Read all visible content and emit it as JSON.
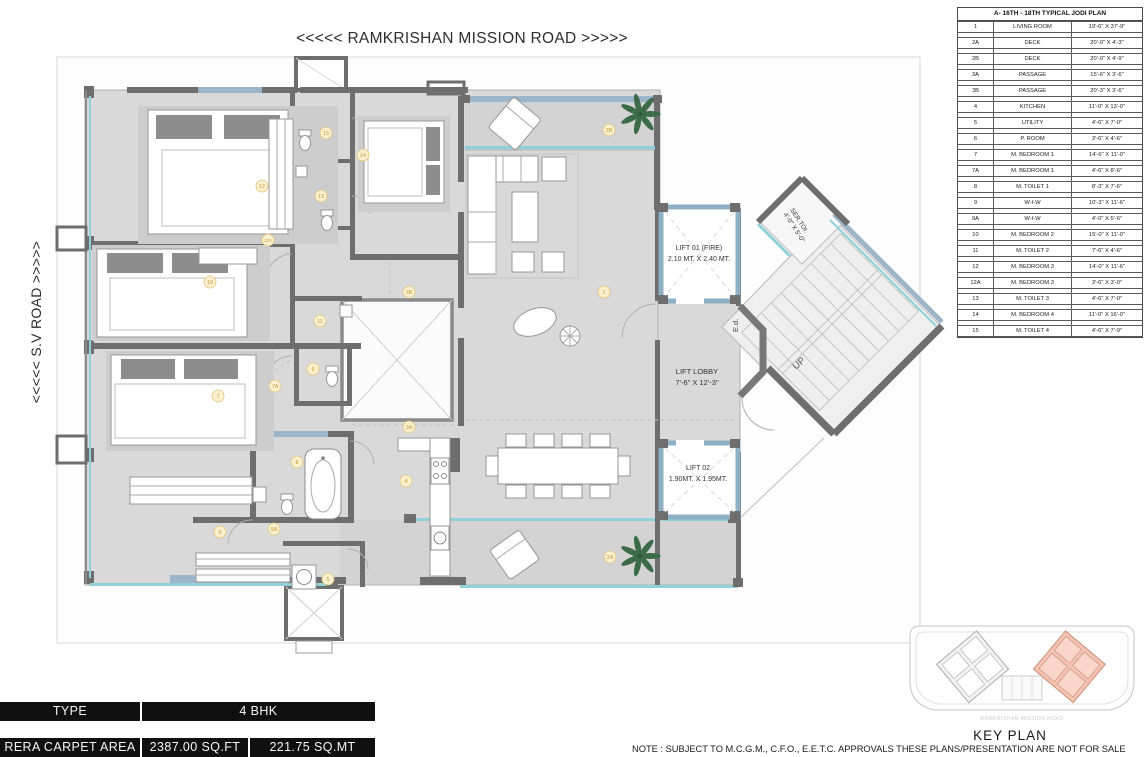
{
  "sheet": {
    "road_top": "<<<<< RAMKRISHAN MISSION ROAD >>>>>",
    "road_left": "<<<<< S.V ROAD >>>>>"
  },
  "plan": {
    "lift1_line1": "LIFT 01 (FIRE)",
    "lift1_line2": "2.10 MT.  X 2.40 MT.",
    "lobby_line1": "LIFT LOBBY",
    "lobby_line2": "7'-6\" X 12'-3\"",
    "lift2_line1": "LIFT 02",
    "lift2_line2": "1.90MT. X 1.95MT.",
    "sertoi_line1": "SER.TOI.",
    "sertoi_line2": "4'-0\" X 5'-0\"",
    "up": "UP",
    "ed": "E.d.",
    "markers": [
      "1",
      "2A",
      "2B",
      "3A",
      "3B",
      "4",
      "5",
      "6",
      "7",
      "7A",
      "8",
      "9",
      "9A",
      "10",
      "11",
      "12",
      "12A",
      "13",
      "14",
      "15"
    ]
  },
  "schedule": {
    "title": "A- 16TH - 18TH TYPICAL JODI PLAN",
    "rows": [
      [
        "1",
        "LIVING ROOM",
        "19'-6\" X 37'-9\""
      ],
      [
        "2A",
        "DECK",
        "20'-0\" X 4'-3\""
      ],
      [
        "2B",
        "DECK",
        "20'-0\" X 4'-9\""
      ],
      [
        "3A",
        "PASSAGE",
        "15'-6\" X 3'-6\""
      ],
      [
        "3B",
        "PASSAGE",
        "20'-3\" X 3'-6\""
      ],
      [
        "4",
        "KITCHEN",
        "11'-0\" X 13'-0\""
      ],
      [
        "5",
        "UTILITY",
        "4'-6\" X 7'-0\""
      ],
      [
        "6",
        "P. ROOM",
        "3'-6\" X 4'-6\""
      ],
      [
        "7",
        "M. BEDROOM 1",
        "14'-6\" X 11'-0\""
      ],
      [
        "7A",
        "M. BEDROOM 1",
        "4'-6\" X 8'-6\""
      ],
      [
        "8",
        "M. TOILET 1",
        "8'-3\" X 7'-6\""
      ],
      [
        "9",
        "W-I-W",
        "10'-3\" X 11'-6\""
      ],
      [
        "9A",
        "W-I-W",
        "4'-0\" X 5'-6\""
      ],
      [
        "10",
        "M. BEDROOM 2",
        "15'-0\" X 11'-0\""
      ],
      [
        "11",
        "M. TOILET 2",
        "7'-6\" X 4'-6\""
      ],
      [
        "12",
        "M. BEDROOM 3",
        "14'-0\" X 11'-6\""
      ],
      [
        "12A",
        "M. BEDROOM 3",
        "3'-6\" X 3'-0\""
      ],
      [
        "13",
        "M. TOILET 3",
        "4'-6\" X 7'-0\""
      ],
      [
        "14",
        "M. BEDROOM 4",
        "11'-0\" X 16'-0\""
      ],
      [
        "15",
        "M. TOILET 4",
        "4'-6\" X 7'-9\""
      ]
    ]
  },
  "key_plan": {
    "label": "KEY PLAN",
    "road_label": "RAMKRISHAN MISSION ROAD"
  },
  "footer": {
    "type_label": "TYPE",
    "type_value": "4 BHK",
    "rera_label": "RERA CARPET AREA",
    "rera_sqft": "2387.00 SQ.FT",
    "rera_sqmt": "221.75 SQ.MT",
    "note": "NOTE : SUBJECT TO M.C.G.M., C.F.O., E.E.T.C. APPROVALS THESE PLANS/PRESENTATION ARE NOT FOR SALE"
  },
  "colors": {
    "wall": "#6e6e6e",
    "wall_blue": "#9db5c8",
    "glass_teal": "#8fd0da",
    "floor": "#d9d9d9",
    "marker_fill": "#faf0cf",
    "marker_stroke": "#e0c478",
    "marker_text": "#c9982f",
    "keyplan_highlight": "#f3c2b2",
    "bar_bg": "#101010"
  }
}
